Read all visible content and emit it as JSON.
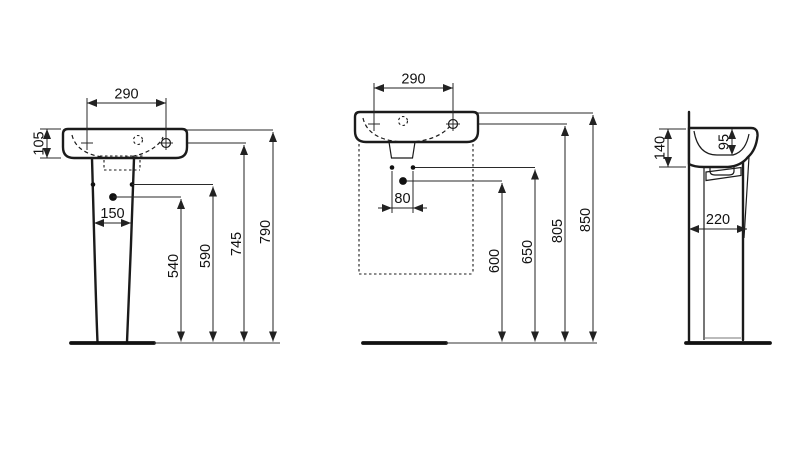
{
  "drawing": {
    "front_pedestal_view": {
      "tap_hole_centres": "290",
      "basin_height": "105",
      "pedestal_fixing_width": "150",
      "height_540": "540",
      "height_590": "590",
      "height_745": "745",
      "height_790": "790"
    },
    "front_wall_view": {
      "tap_hole_centres": "290",
      "fixing_hole_centres": "80",
      "height_600": "600",
      "height_650": "650",
      "height_805": "805",
      "height_850": "850"
    },
    "side_view": {
      "rim_to_underside": "140",
      "bowl_depth": "95",
      "depth": "220"
    }
  },
  "colors": {
    "line": "#1b1b1b",
    "background": "#ffffff"
  }
}
